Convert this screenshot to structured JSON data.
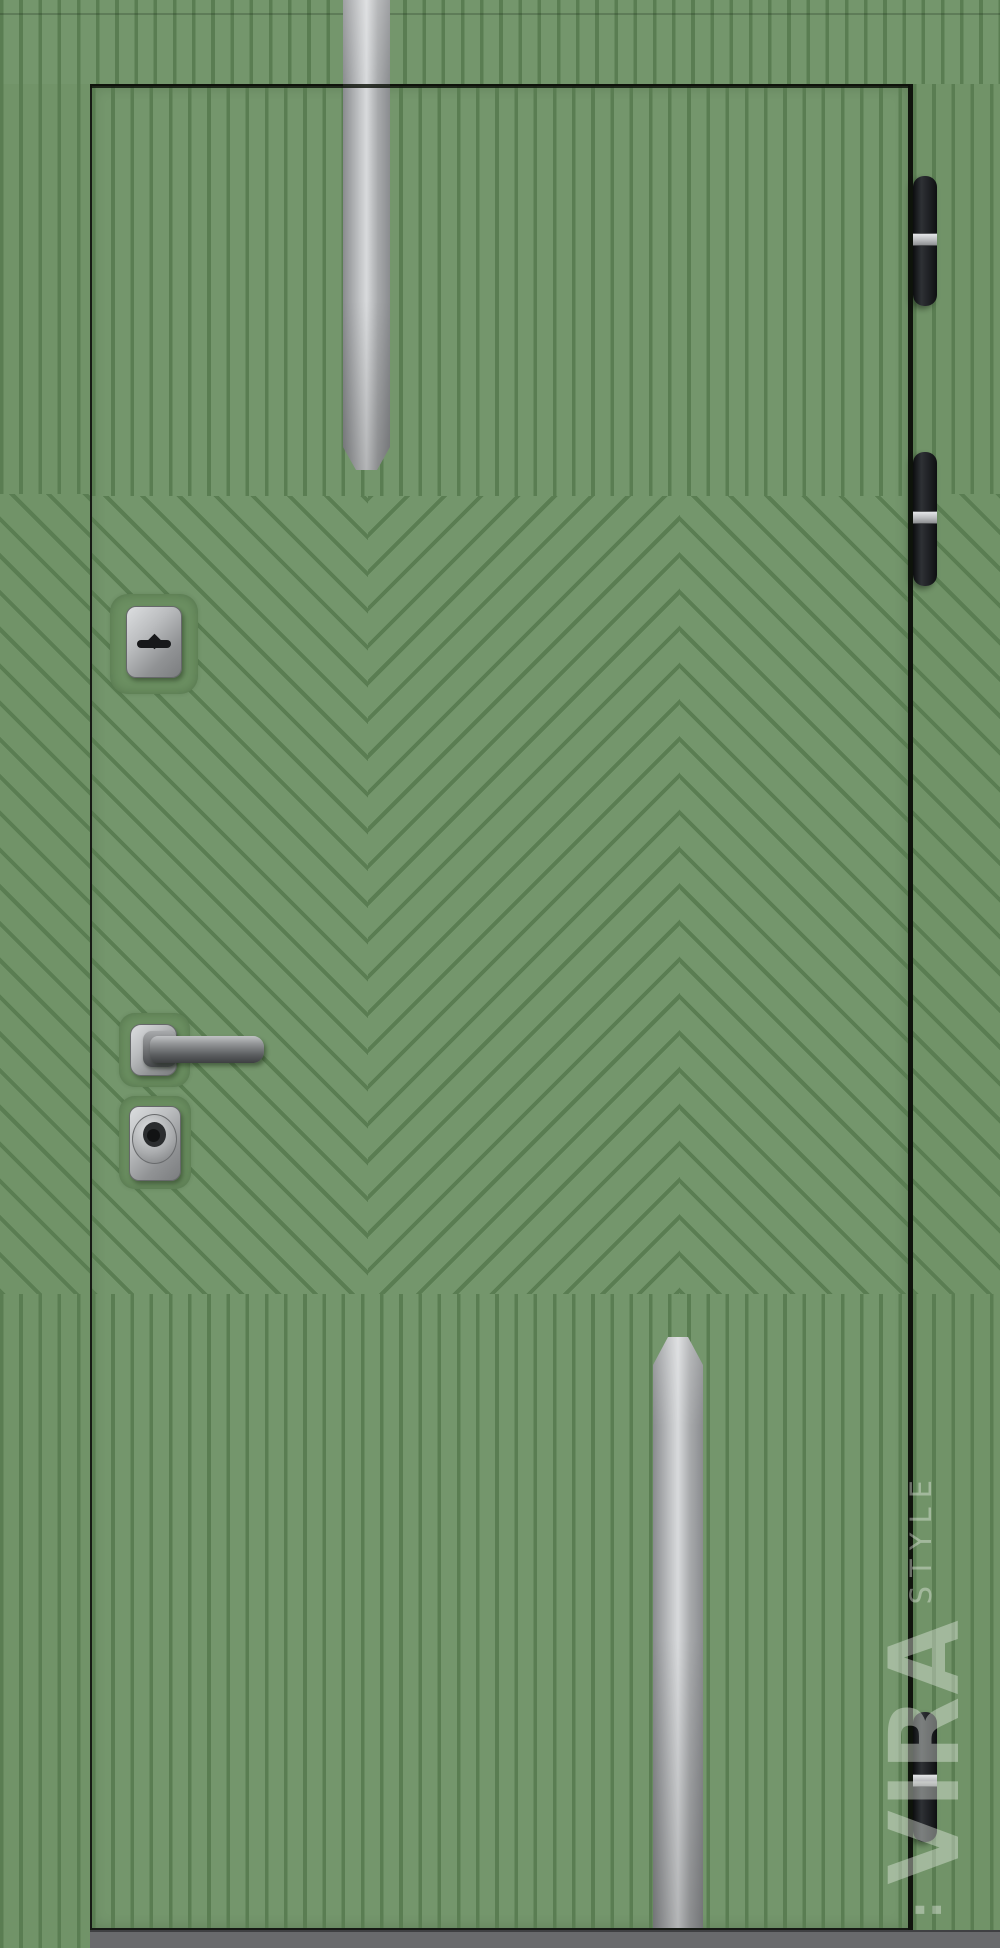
{
  "scene": {
    "subject": "Front view product photo of a closed entrance door with green geometric groove finish",
    "pattern": "vertical grooves at top and bottom, chevron / herringbone grooves in the middle band"
  },
  "palette": {
    "panel_green": "#74966c",
    "groove_green": "#5a7d52",
    "frame_green": "#719368",
    "recess_green": "#6b8f61",
    "outline_dark": "#171a15",
    "gap_dark": "#10140d",
    "threshold_grey": "#696a6c",
    "metal_light": "#d8dadc",
    "metal_mid": "#a8aaac",
    "metal_dark": "#898b8e",
    "hinge_black": "#1b1d20",
    "hinge_band_silver": "#c9cbcd"
  },
  "door": {
    "hinge_count": 3,
    "inlay_count": 2,
    "parts": {
      "top_inlay": "brushed steel vertical inlay",
      "bottom_inlay": "brushed steel vertical inlay",
      "escutcheon": "keyhole escutcheon plate",
      "handle": "lever handle on square rosette",
      "cylinder": "cylinder lock escutcheon",
      "hinges": "black barrel hinges with steel band",
      "threshold": "grey threshold strip"
    }
  },
  "watermark": {
    "mark": ":",
    "line1": "VIRA",
    "line2": "STYLE"
  }
}
